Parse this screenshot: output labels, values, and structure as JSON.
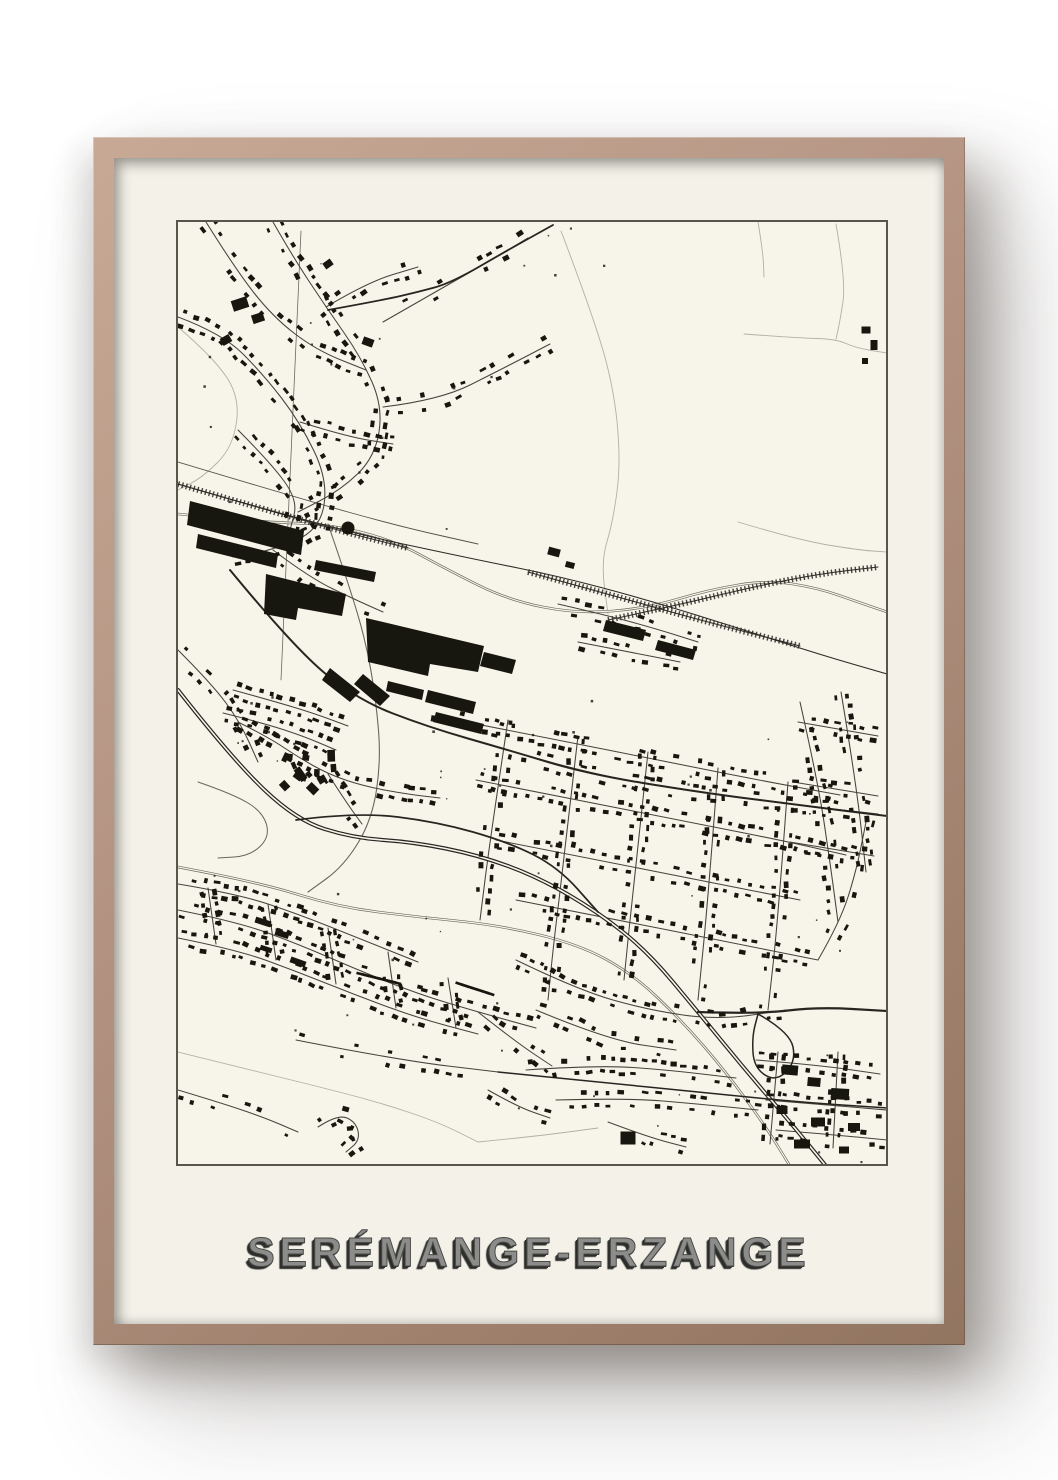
{
  "poster": {
    "title": "SERÉMANGE-ERZANGE"
  },
  "colors": {
    "page_bg": "#ffffff",
    "frame_light": "#c7a995",
    "frame_mid": "#b29180",
    "frame_dark": "#927560",
    "mat": "#f3f1e8",
    "map_bg": "#f7f4ea",
    "map_border": "#57564d",
    "ink": "#17160f",
    "road_minor": "#45443c",
    "road_major": "#26251f",
    "rail": "#2c2b25",
    "river": "#69665a",
    "faint_line": "#b3b0a2",
    "title_fill": "#8c8c8a",
    "title_stroke": "#4a4a47",
    "title_shadow": "#2d2d2b"
  }
}
